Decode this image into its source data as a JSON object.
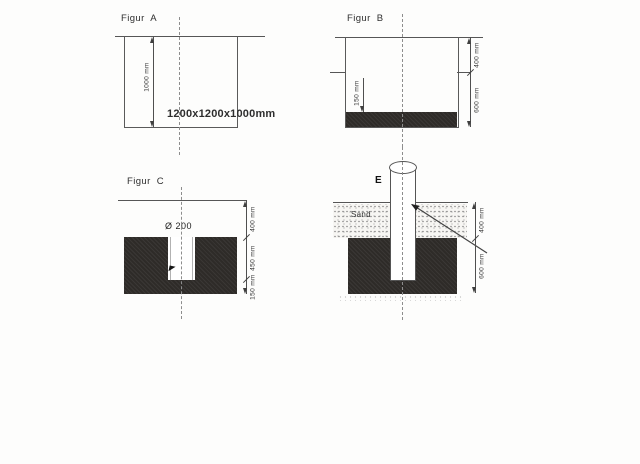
{
  "drawing": {
    "figure_a": {
      "title": "Figur  A",
      "depth_dim": "1000 mm",
      "size_label": "1200x1200x1000mm"
    },
    "figure_b": {
      "title": "Figur  B",
      "top_dim": "400 mm",
      "bottom_dim": "600 mm",
      "layer_dim": "150 mm"
    },
    "figure_c": {
      "title": "Figur  C",
      "hole_dia": "Ø 200",
      "top_dim": "400 mm",
      "hole_dim": "450 mm",
      "base_dim": "150 mm"
    },
    "figure_d": {
      "pole_label": "E",
      "soil_label": "Sand",
      "top_dim": "400 mm",
      "block_dim": "600 mm"
    }
  },
  "colors": {
    "line": "#555555",
    "dark_fill": "#2e2b28",
    "background": "#fdfdfc"
  }
}
